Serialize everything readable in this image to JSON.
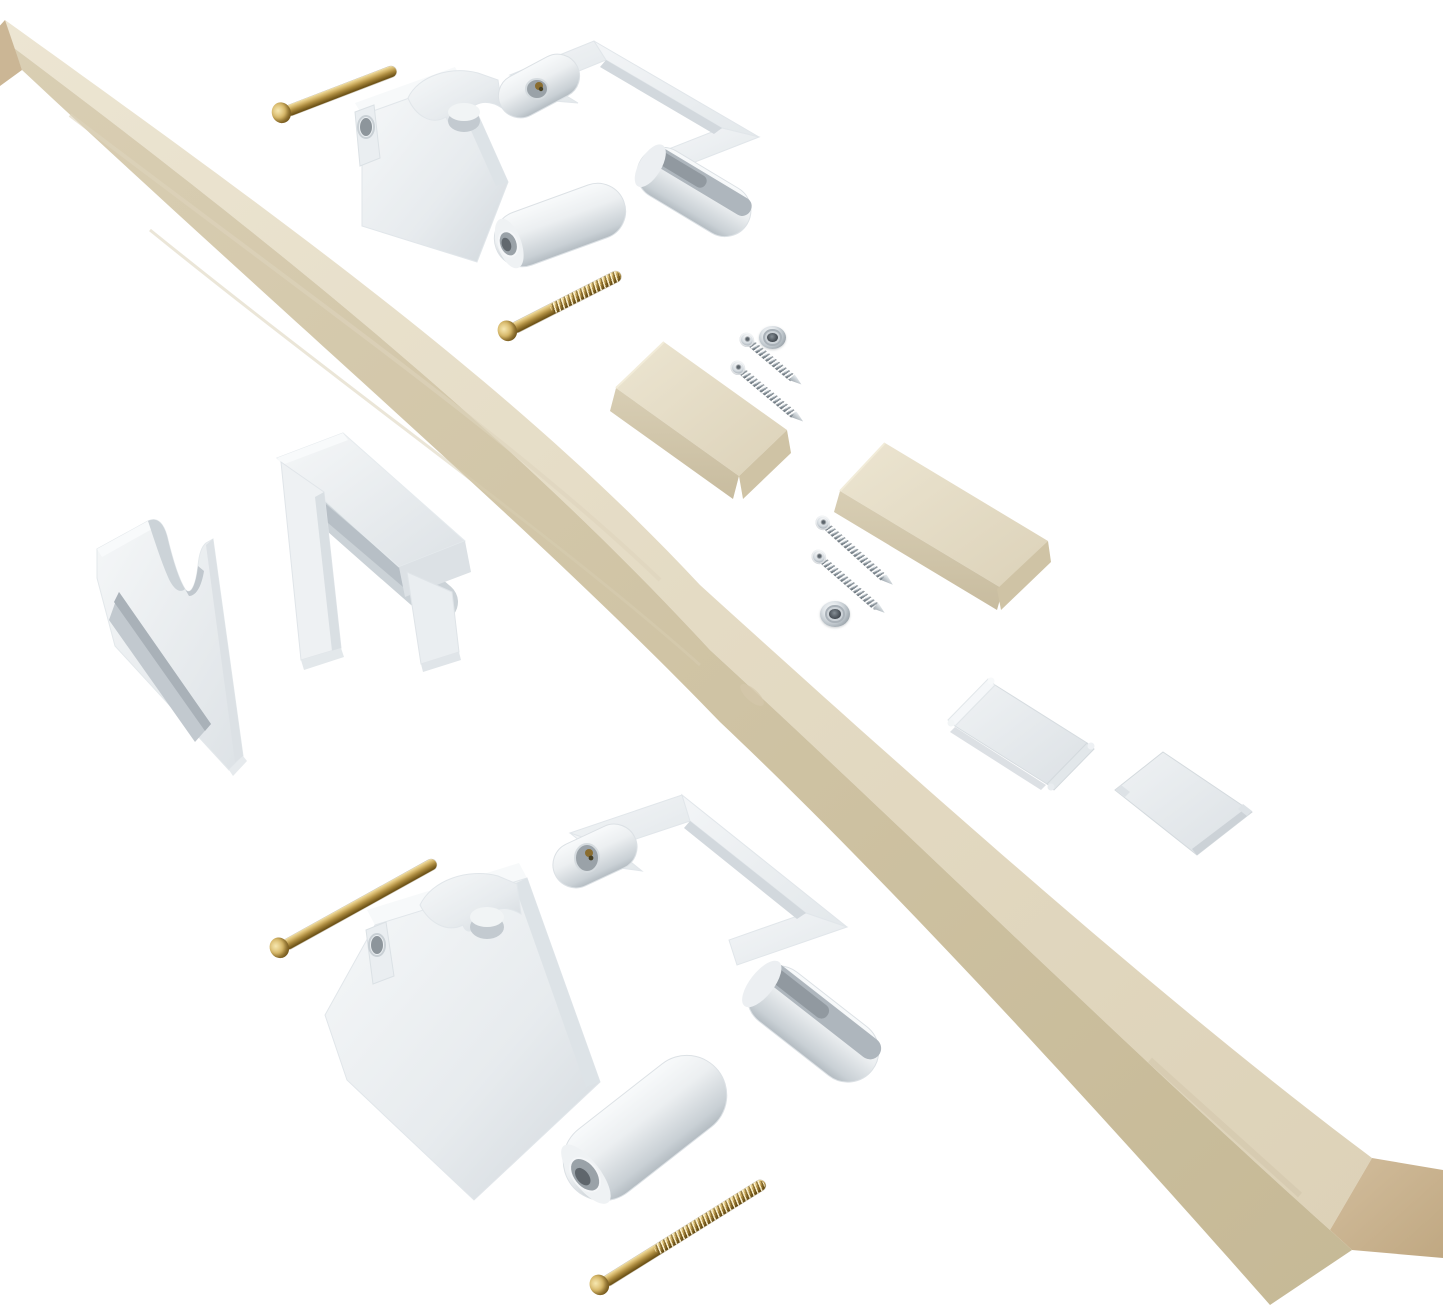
{
  "image": {
    "type": "product-photo",
    "subject": "Stair banister baby-gate installation kit: wooden rail, two-piece white rail clamps, saddle brackets, spacer blocks, cover plates, brass bolts, steel screws and finish washers on a white background",
    "background": "#ffffff"
  },
  "palette": {
    "background": "#ffffff",
    "wood_top": "#e8e0cb",
    "wood_side": "#d5cab0",
    "wood_end": "#c9b492",
    "wood_block_top": "#ece5d1",
    "wood_block_front": "#d6cbb1",
    "plastic": "#f3f5f6",
    "plastic_mid": "#e2e7ea",
    "plastic_shadow": "#c9d0d5",
    "plastic_dark": "#aab2b8",
    "plastic_hole": "#8d959b",
    "brass": "#b3913f",
    "brass_light": "#e7d090",
    "brass_dark": "#6e5418",
    "steel": "#c3cbd1",
    "steel_dark": "#8c959c"
  },
  "parts": {
    "wood_rail": {
      "label": "Wooden hand rail",
      "count": 1
    },
    "wood_blocks": {
      "label": "Wooden spacer block",
      "count": 2
    },
    "clamp_assemblies": {
      "label": "Two-piece white rail clamp",
      "count": 2
    },
    "saddle_brackets": {
      "label": "White saddle bracket",
      "count": 2
    },
    "cover_plates": {
      "label": "White cover plate",
      "count": 2
    },
    "brass_bolts": {
      "label": "Brass machine bolt",
      "count": 4
    },
    "steel_screws": {
      "label": "Steel wood screw",
      "count": 4
    },
    "finish_washers": {
      "label": "Countersunk finish washer",
      "count": 2
    }
  }
}
